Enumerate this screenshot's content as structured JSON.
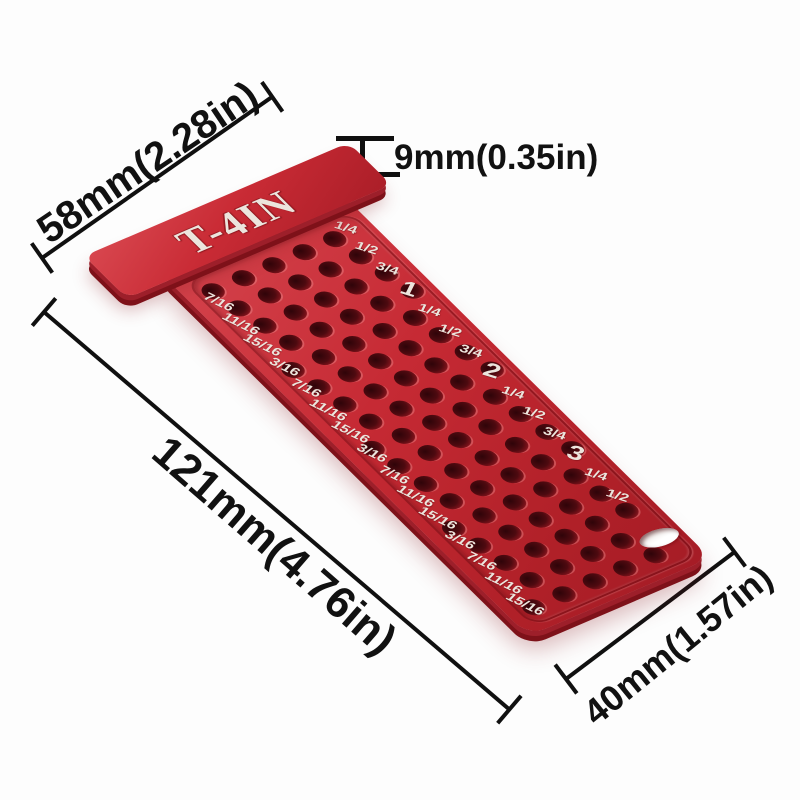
{
  "product": {
    "model_label": "T-4IN"
  },
  "annotations": {
    "head_width": "58mm(2.28in)",
    "lip_thickness": "9mm(0.35in)",
    "total_length": "121mm(4.76in)",
    "body_width": "40mm(1.57in)"
  },
  "scale": {
    "left_labels": [
      "7/16",
      "11/16",
      "15/16",
      "3/16",
      "7/16",
      "11/16",
      "15/16",
      "3/16",
      "7/16",
      "11/16",
      "15/16",
      "3/16",
      "7/16",
      "11/16",
      "15/16"
    ],
    "right_labels": [
      "1/4",
      "1/2",
      "3/4",
      "1",
      "1/4",
      "1/2",
      "3/4",
      "2",
      "1/4",
      "1/2",
      "3/4",
      "3",
      "1/4",
      "1/2"
    ],
    "right_major": [
      false,
      false,
      false,
      true,
      false,
      false,
      false,
      true,
      false,
      false,
      false,
      true,
      false,
      false
    ]
  },
  "colors": {
    "tool_red": "#c4262f",
    "tool_red_dark": "#7e1119",
    "engraving": "#ece5dd",
    "annotation": "#111111",
    "background": "#fdfdfd"
  }
}
